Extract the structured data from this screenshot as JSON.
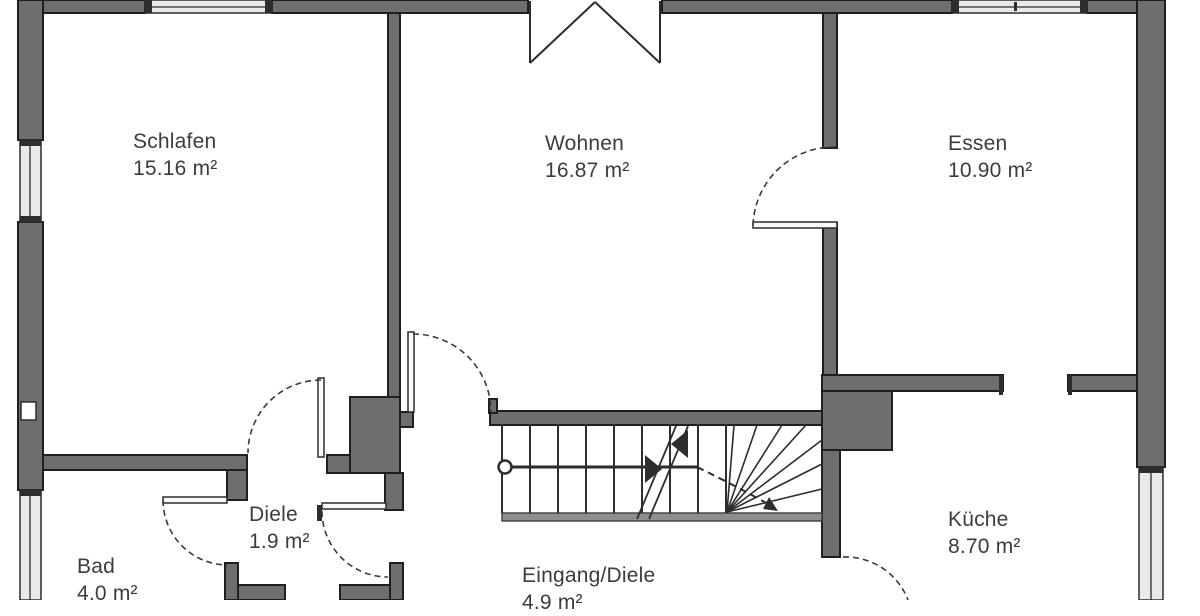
{
  "plan": {
    "title": "Grundriss Erdgeschoss",
    "rooms": [
      {
        "name": "Schlafen",
        "area": "15.16 m²"
      },
      {
        "name": "Wohnen",
        "area": "16.87 m²"
      },
      {
        "name": "Essen",
        "area": "10.90 m²"
      },
      {
        "name": "Bad",
        "area": "4.0 m²"
      },
      {
        "name": "Diele",
        "area": "1.9 m²"
      },
      {
        "name": "Eingang/Diele",
        "area": "4.9 m²"
      },
      {
        "name": "Küche",
        "area": "8.70 m²"
      }
    ],
    "colors": {
      "wall_fill": "#6e6e6e",
      "wall_edge": "#1f1f1f",
      "line": "#2d2d2d",
      "window_fill": "#e9e9e9",
      "text": "#3c3c3c",
      "background": "#ffffff"
    }
  }
}
